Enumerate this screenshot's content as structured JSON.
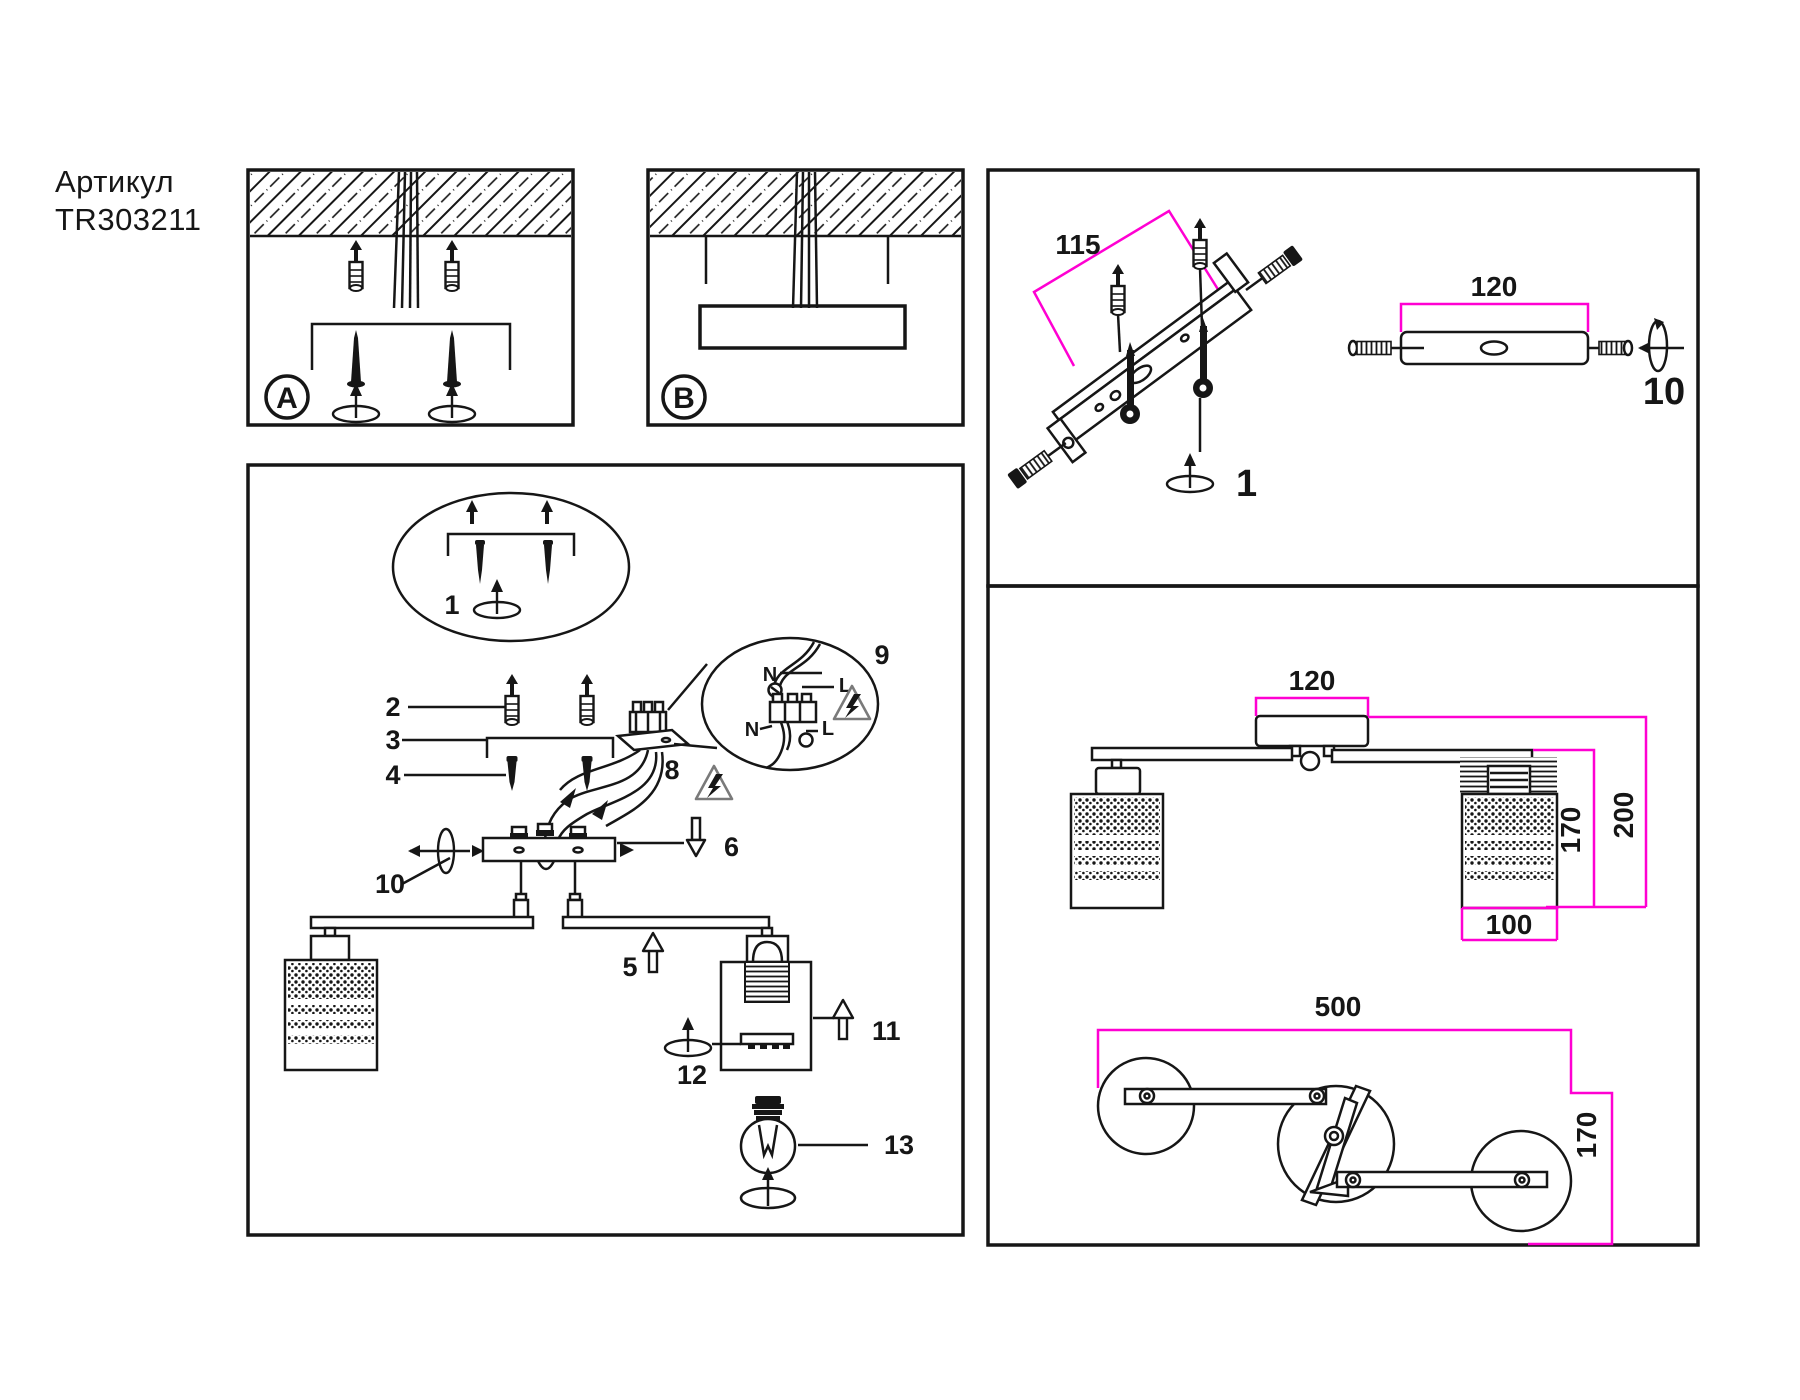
{
  "colors": {
    "ink": "#161616",
    "accent_magenta": "#ff00d2",
    "warning_gray": "#777777"
  },
  "title": {
    "line1": "Артикул",
    "line2": "TR303211"
  },
  "panel_a": {
    "label": "A"
  },
  "panel_b": {
    "label": "B"
  },
  "assembly": {
    "balloon_step": "1",
    "part2": "2",
    "part3": "3",
    "part4": "4",
    "part5": "5",
    "part6": "6",
    "part8": "8",
    "part9": "9",
    "part10": "10",
    "part11": "11",
    "part12": "12",
    "part13": "13",
    "terminal_detail": {
      "neutral_top": "N",
      "line_top": "L",
      "neutral_bottom": "N",
      "line_bottom": "L"
    }
  },
  "bracket_panel": {
    "hole_spacing_mm": "115",
    "bracket_length_mm": "120",
    "screw_step": "10",
    "rotate_step": "1"
  },
  "dimension_panel": {
    "canopy_width_mm": "120",
    "shade_drop_mm": "170",
    "total_drop_mm": "200",
    "shade_width_mm": "100",
    "overall_length_mm": "500",
    "overall_depth_mm": "170"
  }
}
